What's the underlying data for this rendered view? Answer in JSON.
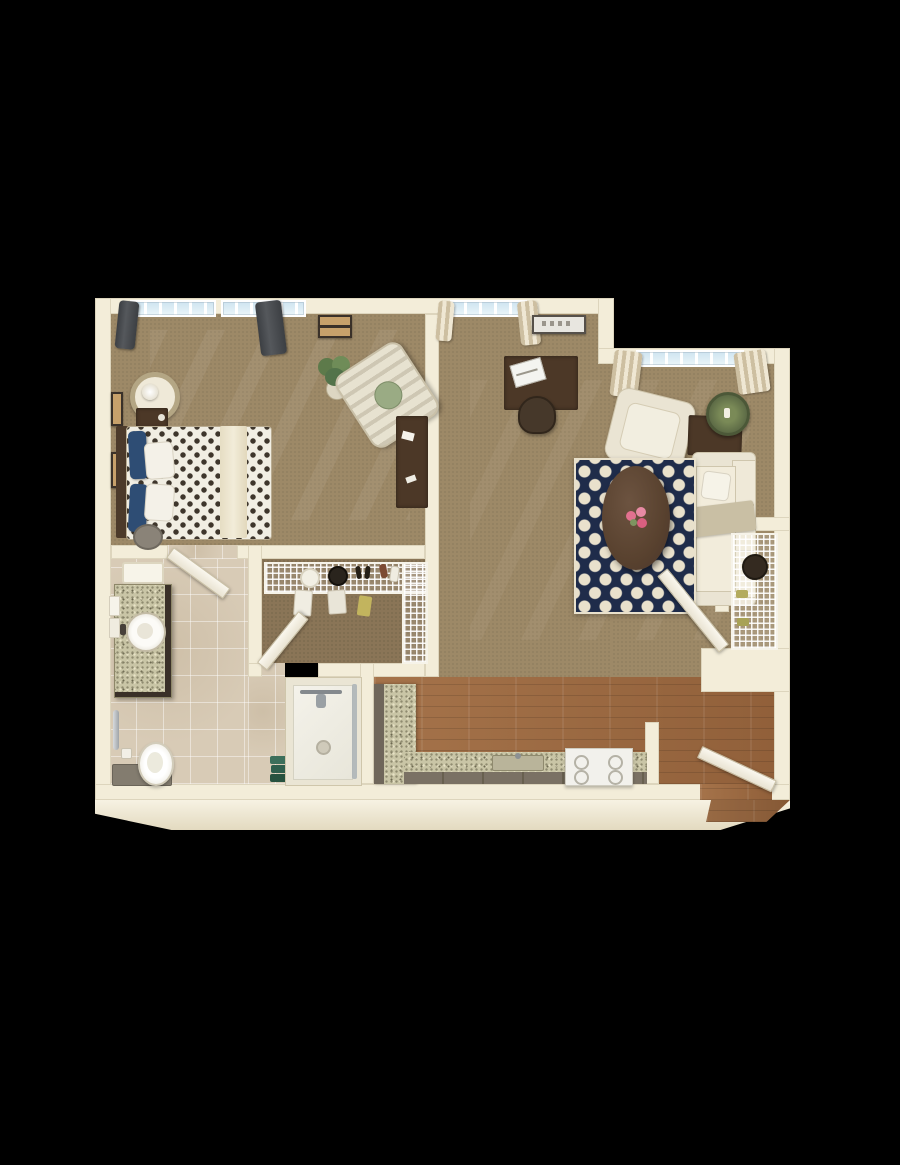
{
  "scene": {
    "description": "3D rendered top-down floor plan of a one-bedroom apartment on a black background",
    "background_color": "#000000",
    "style": "photoreal dollhouse render, no text labels"
  },
  "palette": {
    "wall": "#f3edd9",
    "wall_shadow": "#ddd2b6",
    "carpet": "#9d8967",
    "closet_carpet": "#8a7557",
    "bathroom_tile": "#d8cbb6",
    "wood_floor": "#9c6a42",
    "rug_navy": "#1f2c4a",
    "rug_cream": "#e9e1cc",
    "sofa_cream": "#eae4d3",
    "granite_counter": "#c9c5a6",
    "cabinet_gray": "#6f665a",
    "dark_wood_furniture": "#4c3827",
    "curtain_dark": "#45484c",
    "curtain_tan": "#cdbfa1",
    "pillow_navy": "#2e4d74",
    "flower_pink": "#e2718f",
    "towel_green": "#2f5f4d",
    "plant_green": "#5d7a4a",
    "window_glass": "#cfe4f0"
  },
  "rooms": {
    "bedroom": {
      "items": [
        "bed with patterned duvet",
        "navy and white pillows",
        "headboard",
        "nightstand",
        "round side table with lamp",
        "laundry hamper",
        "striped armchair with green pillow",
        "writing desk",
        "potted plant",
        "two windows with dark curtains",
        "wall art frames"
      ]
    },
    "living_room": {
      "items": [
        "cream sofa with throw",
        "cream armchair",
        "oval coffee table with pink flowers",
        "navy quatrefoil rug",
        "desk with laptop and chair",
        "side table with green basket plant",
        "potted plant",
        "two windows with striped curtains",
        "wall art",
        "linen closet with wire shelves and basket",
        "open closet door"
      ]
    },
    "walk_in_closet": {
      "items": [
        "wire shelving with hats and shoes",
        "hanging clothes",
        "open closet door"
      ]
    },
    "bathroom": {
      "items": [
        "granite vanity with round vessel sink",
        "towels on towel bar",
        "ceiling light panel",
        "grab bar",
        "toilet",
        "gray bench cabinet",
        "walk-in shower with glass door",
        "stacked green towels"
      ]
    },
    "kitchen": {
      "items": [
        "L-shaped granite counter",
        "gray cabinet fronts",
        "inset sink",
        "white range",
        "wood flooring"
      ]
    },
    "entry": {
      "items": [
        "open front door",
        "wood flooring",
        "exterior threshold"
      ]
    }
  }
}
